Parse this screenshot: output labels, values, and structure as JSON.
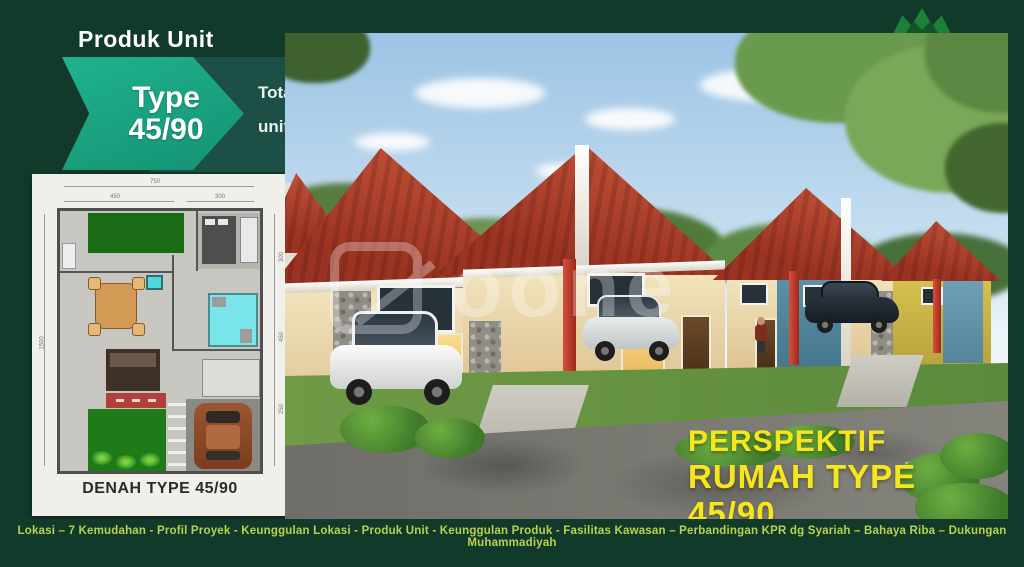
{
  "slide": {
    "title": "Produk Unit",
    "type_badge": {
      "line1": "Type",
      "line2": "45/90"
    },
    "info_box": {
      "line1": "Total 406",
      "line2": "unit rumah,"
    },
    "floor_plan": {
      "caption": "DENAH TYPE 45/90",
      "dims": {
        "top_total": "750",
        "top_left": "450",
        "top_right": "300",
        "left_total": "1500",
        "right_top": "300",
        "right_mid": "450",
        "right_bottom": "250"
      }
    },
    "photo": {
      "overlay_line1": "PERSPEKTIF",
      "overlay_line2": "RUMAH TYPE 45/90",
      "watermark_text": "oone"
    },
    "footer": {
      "nav_text": "Lokasi – 7 Kemudahan - Profil Proyek - Keunggulan Lokasi - Produk Unit - Keunggulan Produk - Fasilitas Kawasan – Perbandingan KPR dg Syariah – Bahaya Riba – Dukungan Muhammadiyah"
    },
    "colors": {
      "background_green": "#123A2A",
      "accent_teal": "#17A084",
      "info_teal": "#1C4F45",
      "overlay_yellow": "#F5E71C",
      "nav_green": "#B8D14E",
      "roof_red": "#A93A27"
    }
  }
}
